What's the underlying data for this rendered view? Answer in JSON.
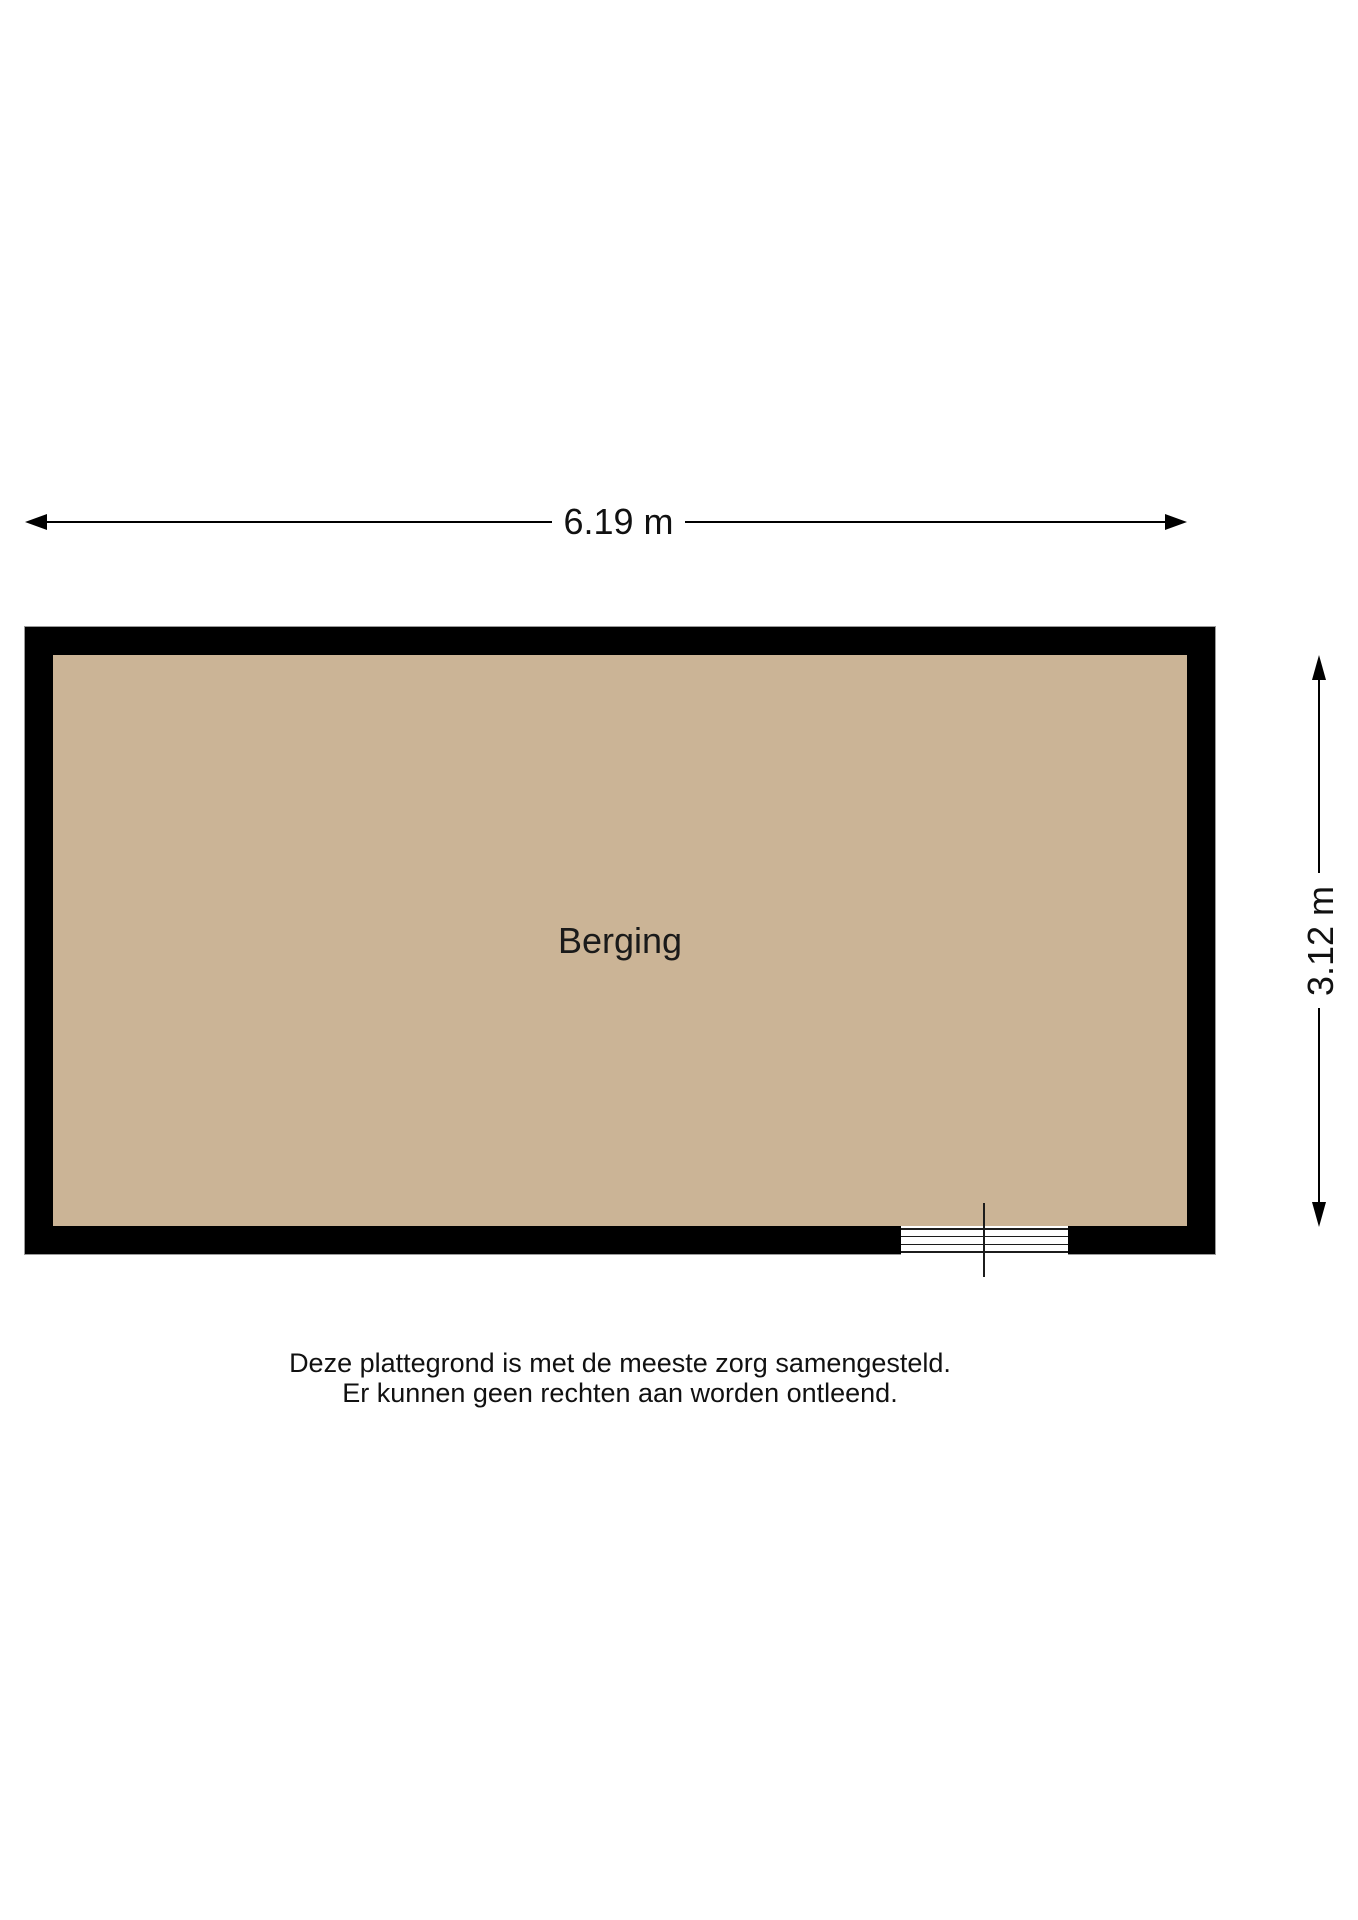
{
  "floorplan": {
    "room": {
      "label": "Berging",
      "floor_color": "#cbb496",
      "wall_color": "#000000"
    },
    "dimensions": {
      "width_label": "6.19 m",
      "height_label": "3.12 m"
    },
    "door": {
      "type": "wall-opening-with-threshold-and-door-leaf",
      "threshold_line_count": 4
    },
    "disclaimer": {
      "line1": "Deze plattegrond is met de meeste zorg samengesteld.",
      "line2": "Er kunnen geen rechten aan worden ontleend."
    },
    "icons": {
      "arrow_left": "triangle-left",
      "arrow_right": "triangle-right",
      "arrow_up": "triangle-up",
      "arrow_down": "triangle-down"
    }
  }
}
